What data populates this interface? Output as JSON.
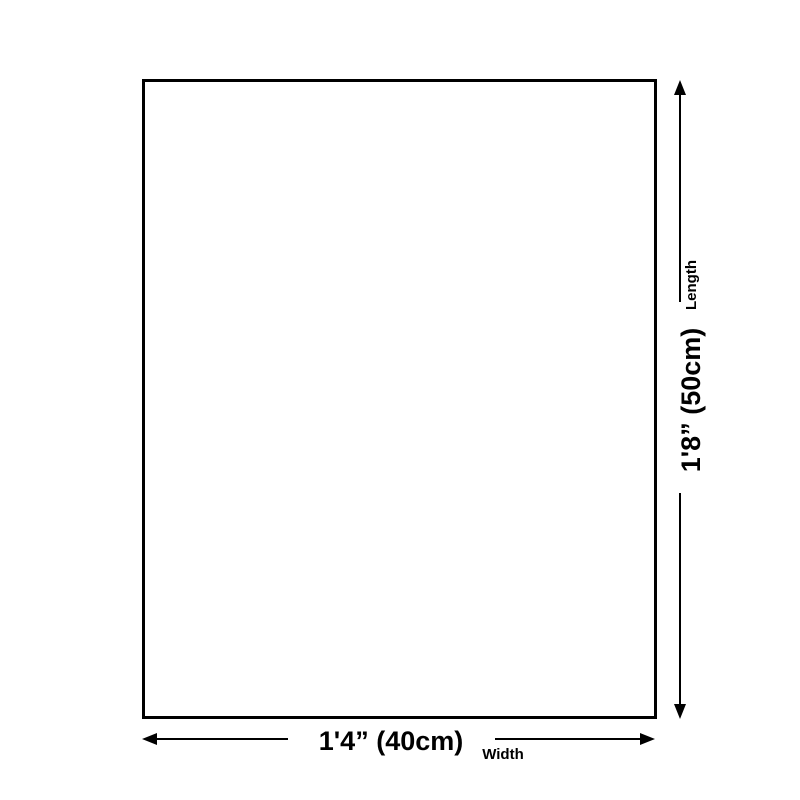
{
  "page": {
    "background_color": "#ffffff",
    "line_color": "#000000"
  },
  "diagram": {
    "shape": "rectangle-outline",
    "length": {
      "label": "Length",
      "value": "1'8” (50cm)"
    },
    "width": {
      "label": "Width",
      "value": "1'4” (40cm)"
    }
  }
}
